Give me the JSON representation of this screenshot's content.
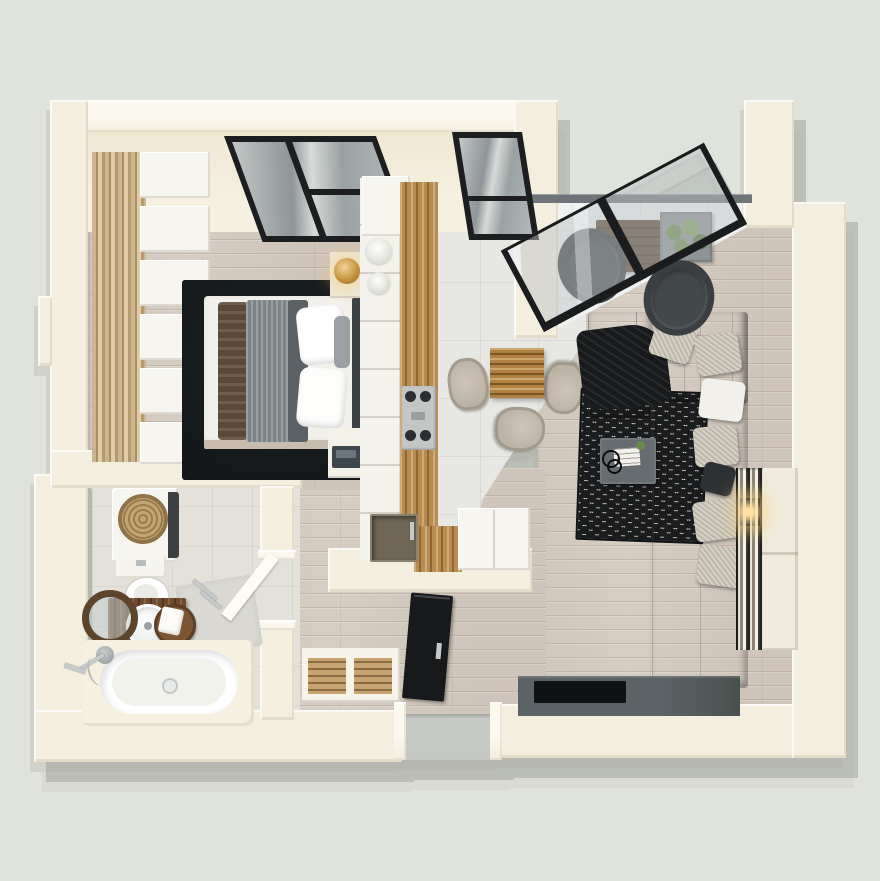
{
  "scene": {
    "title": "3D rendered top-down floor plan of a one-bedroom apartment",
    "style": "photoreal axonometric architectural render, no text labels",
    "background": "#e0e2dc"
  },
  "palette": {
    "background": "#e0e2dc",
    "wall": "#f4eede",
    "wall-cap": "#fbf8ee",
    "wall-face": "#f6f0e0",
    "wood": "#d6cdc3",
    "tile": "#e7e7e4",
    "bath-tile": "#e3e1da",
    "balcony-tile": "#f0f2f1",
    "rug": "#14181a",
    "sofa": "#4d5153",
    "cushion": "#c9c2b4",
    "counter-wood": "#b88c4e",
    "table-wood": "#b08142",
    "vanity-wood": "#6e4b2e",
    "chair-beige": "#b9b1a3",
    "frame-black": "#1a1c1e",
    "door-black": "#17191b",
    "glass": "#9aa1a2",
    "console": "#5c6367",
    "tv": "#0e1112",
    "gold": "#e0b96a",
    "plant-green": "#6b8a50",
    "chrome": "#c6c9ca",
    "wicker": "#ab8d5d",
    "rattan": "#3b3f42"
  },
  "rooms": [
    {
      "id": "bedroom",
      "label": "Bedroom",
      "items": [
        "double bed with white pillows",
        "gray knit blanket",
        "brown throw",
        "black area rug",
        "headboard",
        "nightstand with gold lamp",
        "nightstand with radio",
        "open wardrobe shelving on wood panel",
        "black-framed window"
      ]
    },
    {
      "id": "kitchen",
      "label": "Kitchen",
      "items": [
        "white shelf divider with dishes",
        "tall white cabinet",
        "wooden counter",
        "gas cooktop",
        "dark sink with faucet",
        "corner counter",
        "white fridge cabinet",
        "black-framed window"
      ]
    },
    {
      "id": "dining",
      "label": "Dining area",
      "items": [
        "square wooden table",
        "three beige upholstered chairs",
        "large gray floor tiles"
      ]
    },
    {
      "id": "living",
      "label": "Living room",
      "items": [
        "charcoal corner sofa",
        "textured beige cushions",
        "black throw blanket",
        "black-and-white chevron rug",
        "gray coffee table with books and plant",
        "TV console",
        "flat TV on bottom wall",
        "cream bookshelf with warm light"
      ]
    },
    {
      "id": "balcony",
      "label": "Balcony",
      "items": [
        "leaning sliding glass wall",
        "railing",
        "two dark rattan chairs",
        "dark wood table",
        "planter with greenery",
        "white tile floor"
      ]
    },
    {
      "id": "bathroom",
      "label": "Bathroom",
      "items": [
        "built-in bathtub with deck",
        "shower mixer and hand shower",
        "washing machine with wicker laundry basket",
        "toilet",
        "wooden vanity with round basin",
        "round wood-framed mirror",
        "wood stool with towel",
        "bath mat",
        "dark plant",
        "open white door"
      ]
    },
    {
      "id": "hall",
      "label": "Entrance hall",
      "items": [
        "black entry door standing open",
        "gray threshold",
        "slatted shoe bench",
        "wood plank floor"
      ]
    }
  ]
}
